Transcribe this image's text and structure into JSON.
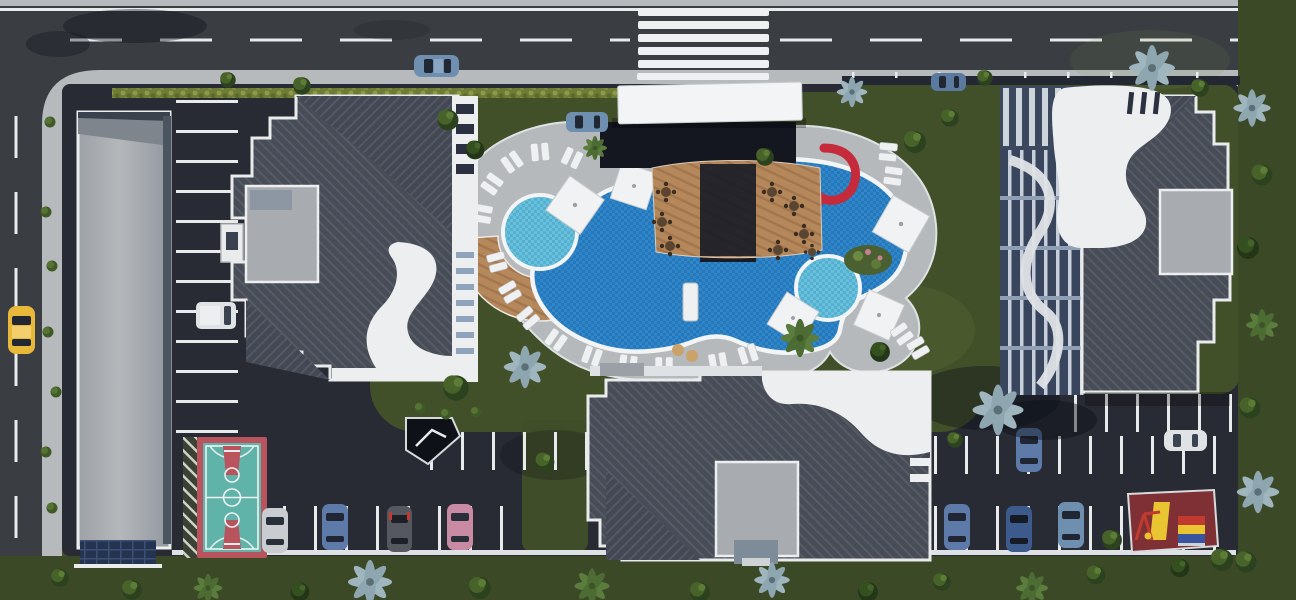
{
  "scene": {
    "description": "Aerial top-down 3D architectural rendering of a residential complex: three dark-roofed apartment blocks with white curved facades around a large organic-shaped swimming pool with kids pool, spa pool and red spiral waterslide, surrounded by parking lots, a basketball court, a playground, lawns and palm trees, bordered by an asphalt road on the top and left edges",
    "view": "top-down aerial",
    "style": "photorealistic 3D render",
    "time_of_day": "daylight with long tree shadows"
  },
  "colors": {
    "road_asphalt": "#3a3d41",
    "lot_asphalt": "#282a34",
    "sidewalk": "#b7babd",
    "grass": "#42502a",
    "grass_light": "#7c9147",
    "roof_dark": "#4a4f59",
    "facade_white": "#eceef0",
    "roof_gray_box": "#a8acb1",
    "long_building_roof": "#aaaeb2",
    "pool_water": "#2f86c8",
    "pool_water_light": "#68c0dc",
    "deck_stone": "#b6b9bb",
    "deck_wood": "#b5885c",
    "umbrella_white": "#f0f2f3",
    "taxi_yellow": "#e8b83a",
    "slide_red": "#c62b3c",
    "slide_blue": "#2f6fc4",
    "court_teal": "#5fb3a8",
    "court_red": "#b9545e",
    "playground_floor": "#7e3034",
    "playground_yellow": "#e9c531",
    "tree_green": "#47632a",
    "palm_blue": "#9fb6bf",
    "palm_green": "#5a7c3d",
    "line_white": "#e8eaec",
    "canopy_white": "#f2f4f5",
    "entrance_dark": "#141720",
    "solar_panel_blue": "#243350"
  },
  "inventory": {
    "roads": {
      "horizontal_top_road": 1,
      "vertical_left_road": 1,
      "crosswalk_stripes": 6,
      "lane_marking_style": "white dashes with solid edge line"
    },
    "buildings": {
      "west_apartment_block": 1,
      "east_apartment_block": 1,
      "south_apartment_block": 1,
      "long_flat_roof_building": 1,
      "entrance_canopy": 1,
      "guard_booth": 1,
      "underground_ramp": 1
    },
    "pool_area": {
      "main_pool": 1,
      "kids_pool": 1,
      "round_spa_pool": 1,
      "red_spiral_waterslide": 1,
      "straight_waterslides": 2,
      "white_umbrellas": 5,
      "sun_lounger_pairs": 18,
      "cafe_tables": 8,
      "timber_arc_deck": 1,
      "pool_bridge": 1
    },
    "sports": {
      "basketball_court": 1,
      "playground": 1
    },
    "vehicles": {
      "yellow_taxi": 1,
      "white_van": 1,
      "parked_and_moving_cars": 12,
      "car_colors": [
        "blue",
        "silver",
        "dark-gray",
        "pink",
        "navy",
        "white"
      ]
    },
    "vegetation": {
      "blue_palm_trees": 8,
      "green_palm_trees": 6,
      "round_green_trees": 24,
      "small_bushes": 10,
      "hedge_rows": 1
    }
  }
}
